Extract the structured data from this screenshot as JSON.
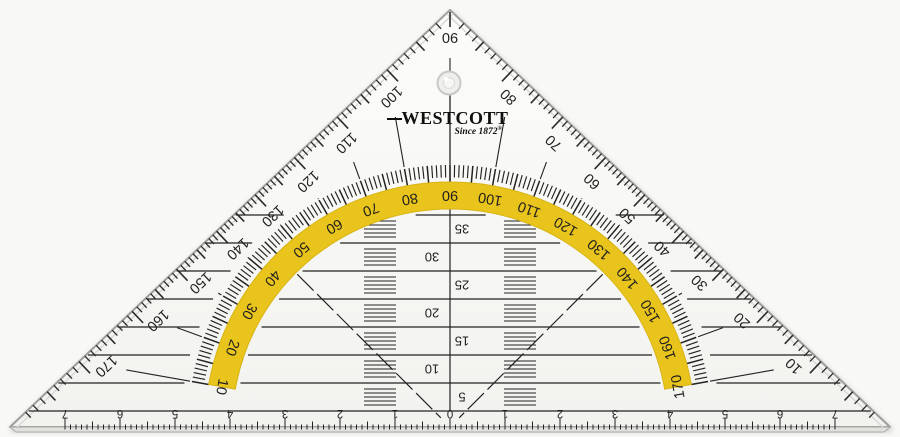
{
  "brand": {
    "name": "WESTCOTT",
    "tagline": "Since 1872",
    "registered_mark": "®"
  },
  "protractor": {
    "outer_degree_labels": [
      "10",
      "20",
      "30",
      "40",
      "50",
      "60",
      "70",
      "80",
      "90",
      "100",
      "110",
      "120",
      "130",
      "140",
      "150",
      "160",
      "170"
    ],
    "inner_degree_labels": [
      "10",
      "20",
      "30",
      "40",
      "50",
      "60",
      "70",
      "80",
      "90",
      "100",
      "110",
      "120",
      "130",
      "140",
      "150",
      "160",
      "170"
    ],
    "labeled_step_deg": 10,
    "minor_step_deg": 1
  },
  "parallel_line_scale": {
    "labels": [
      "5",
      "10",
      "15",
      "20",
      "25",
      "30",
      "35"
    ]
  },
  "ruler": {
    "center_label": "0",
    "cm_labels": [
      "1",
      "2",
      "3",
      "4",
      "5",
      "6",
      "7"
    ]
  },
  "colors": {
    "band_yellow": "#e9c41c",
    "band_edge": "#d8b414",
    "print_black": "#222222",
    "plastic_edge_gray": "#9e9e9e",
    "background": "#f8f8f6"
  }
}
